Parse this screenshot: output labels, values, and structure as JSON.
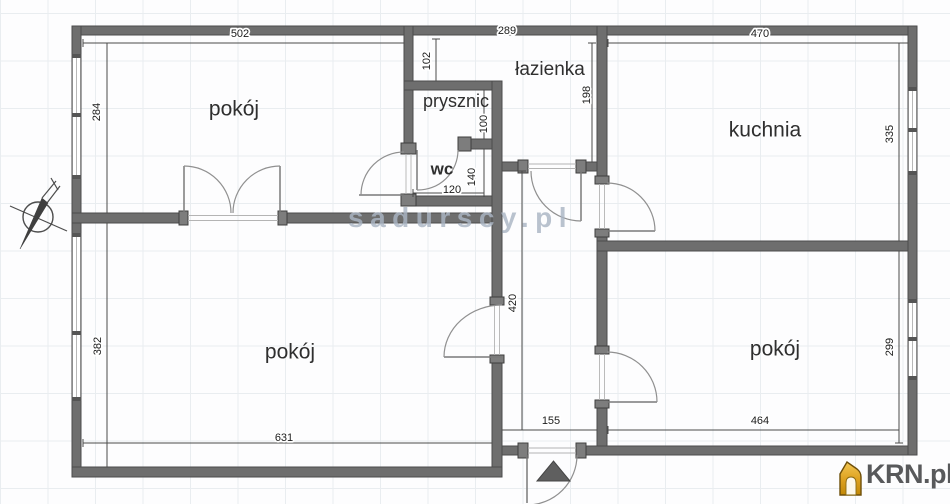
{
  "watermark": {
    "text": "sadurscy.pl"
  },
  "brand": {
    "logo_text": "KRN.pl"
  },
  "rooms": {
    "top_left": "pokój",
    "bottom_left": "pokój",
    "bottom_right": "pokój",
    "kitchen": "kuchnia",
    "bathroom": "łazienka",
    "shower": "prysznic",
    "toilet": "wc"
  },
  "dims": {
    "d502": "502",
    "d284": "284",
    "d289": "289",
    "d102": "102",
    "d470": "470",
    "d335": "335",
    "d198": "198",
    "d100": "100",
    "d140": "140",
    "d120": "120",
    "d382": "382",
    "d631": "631",
    "d420": "420",
    "d155": "155",
    "d464": "464",
    "d299": "299"
  },
  "colors": {
    "wall": "#6e6e6e",
    "wall_edge": "#4c4c4c",
    "dimension_text": "#1c1c1c",
    "watermark": "#aab5c3",
    "logo_text": "#58595b",
    "logo_gold": "#d9980f",
    "entrance_marker": "#5f5f5f"
  }
}
